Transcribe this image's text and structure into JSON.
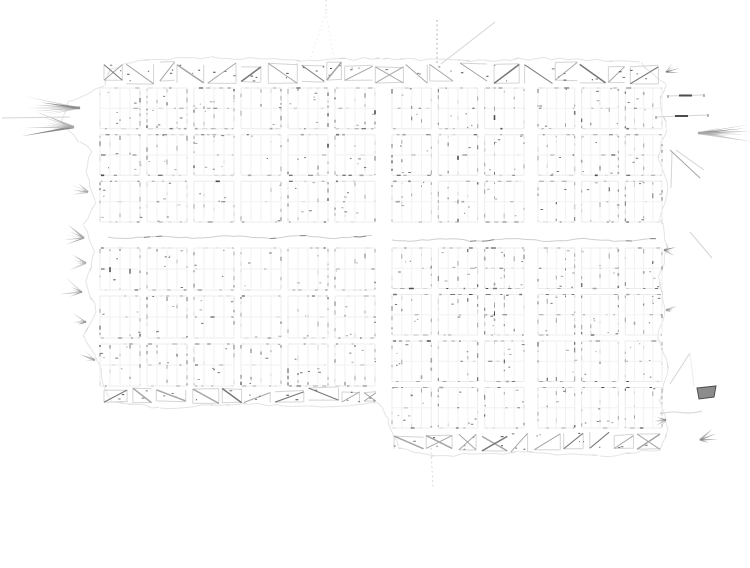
{
  "page": {
    "background": "#ffffff"
  },
  "map": {
    "canvas": {
      "width": 750,
      "height": 568
    },
    "seed": 1337,
    "palette": {
      "paper": "#ffffff",
      "faint": "#ececec",
      "lot": "#f2f2f2",
      "light": "#d4d4d4",
      "mid": "#a6a6a6",
      "dark": "#777777",
      "ink": "#4d4d4d",
      "wave": "#cfcfcf",
      "wave_dark": "#8a8a8a",
      "boundary": "#e4e4e4"
    },
    "street_gap": 7,
    "row_gap": 6,
    "sections": [
      {
        "name": "west",
        "x0": 100,
        "x1": 375,
        "cols": 6
      },
      {
        "name": "central",
        "x0": 392,
        "x1": 524,
        "cols": 3
      },
      {
        "name": "east",
        "x0": 538,
        "x1": 662,
        "cols": 3
      }
    ],
    "halves": [
      {
        "name": "north",
        "y0": 88,
        "y1": 222,
        "rows": 3,
        "sections": [
          0,
          1,
          2
        ]
      },
      {
        "name": "south-west",
        "y0": 248,
        "y1": 386,
        "rows": 3,
        "sections": [
          0
        ]
      },
      {
        "name": "south-east",
        "y0": 248,
        "y1": 428,
        "rows": 4,
        "sections": [
          1,
          2
        ]
      }
    ],
    "lots": {
      "cols": 4,
      "rows": 2
    },
    "hatch_bands": [
      {
        "x0": 104,
        "x1": 660,
        "y0": 62,
        "y1": 84
      },
      {
        "x0": 104,
        "x1": 376,
        "y0": 388,
        "y1": 404
      },
      {
        "x0": 394,
        "x1": 660,
        "y0": 432,
        "y1": 452
      }
    ],
    "waves": [
      {
        "x0": 108,
        "x1": 374,
        "y": 237
      },
      {
        "x0": 392,
        "x1": 658,
        "y": 240
      }
    ],
    "fade_zones": [
      {
        "cx": 250,
        "cy": 155,
        "rx": 16,
        "ry": 68
      },
      {
        "cx": 262,
        "cy": 290,
        "rx": 13,
        "ry": 52
      }
    ],
    "dense_zones": [
      {
        "cx": 500,
        "cy": 300,
        "rx": 16,
        "ry": 85
      },
      {
        "cx": 310,
        "cy": 383,
        "rx": 75,
        "ry": 14
      },
      {
        "cx": 185,
        "cy": 118,
        "rx": 65,
        "ry": 26
      }
    ],
    "boundary": [
      [
        104,
        86
      ],
      [
        88,
        94
      ],
      [
        68,
        102
      ],
      [
        62,
        122
      ],
      [
        80,
        142
      ],
      [
        92,
        152
      ],
      [
        86,
        172
      ],
      [
        96,
        202
      ],
      [
        84,
        226
      ],
      [
        94,
        252
      ],
      [
        86,
        282
      ],
      [
        96,
        312
      ],
      [
        84,
        336
      ],
      [
        98,
        362
      ],
      [
        104,
        386
      ],
      [
        112,
        402
      ],
      [
        160,
        408
      ],
      [
        250,
        404
      ],
      [
        330,
        407
      ],
      [
        378,
        403
      ],
      [
        388,
        420
      ],
      [
        398,
        448
      ],
      [
        430,
        456
      ],
      [
        520,
        452
      ],
      [
        600,
        456
      ],
      [
        660,
        450
      ],
      [
        668,
        430
      ],
      [
        660,
        400
      ],
      [
        668,
        368
      ],
      [
        658,
        338
      ],
      [
        665,
        308
      ],
      [
        658,
        278
      ],
      [
        668,
        248
      ],
      [
        660,
        218
      ],
      [
        668,
        188
      ],
      [
        658,
        158
      ],
      [
        666,
        128
      ],
      [
        660,
        98
      ],
      [
        666,
        84
      ],
      [
        640,
        62
      ],
      [
        560,
        58
      ],
      [
        470,
        61
      ],
      [
        380,
        58
      ],
      [
        300,
        61
      ],
      [
        210,
        57
      ],
      [
        140,
        60
      ],
      [
        110,
        70
      ],
      [
        104,
        86
      ]
    ],
    "features": [
      {
        "type": "rays",
        "x": 80,
        "y": 108,
        "dir": 180,
        "count": 7,
        "len": 58,
        "spread": 24
      },
      {
        "type": "rays",
        "x": 74,
        "y": 127,
        "dir": 186,
        "count": 8,
        "len": 50,
        "spread": 32
      },
      {
        "type": "line",
        "x1": 2,
        "y1": 118,
        "x2": 70,
        "y2": 117,
        "tone": "light"
      },
      {
        "type": "rays",
        "x": 88,
        "y": 192,
        "dir": 196,
        "count": 4,
        "len": 18,
        "spread": 52
      },
      {
        "type": "rays",
        "x": 84,
        "y": 238,
        "dir": 190,
        "count": 5,
        "len": 20,
        "spread": 60
      },
      {
        "type": "rays",
        "x": 86,
        "y": 263,
        "dir": 184,
        "count": 4,
        "len": 16,
        "spread": 55
      },
      {
        "type": "rays",
        "x": 82,
        "y": 292,
        "dir": 190,
        "count": 5,
        "len": 21,
        "spread": 62
      },
      {
        "type": "rays",
        "x": 86,
        "y": 322,
        "dir": 188,
        "count": 4,
        "len": 16,
        "spread": 50
      },
      {
        "type": "rays",
        "x": 95,
        "y": 360,
        "dir": 200,
        "count": 3,
        "len": 14,
        "spread": 42
      },
      {
        "type": "rays",
        "x": 666,
        "y": 72,
        "dir": -25,
        "count": 4,
        "len": 16,
        "spread": 55
      },
      {
        "type": "dashline",
        "x1": 668,
        "y1": 96,
        "x2": 704,
        "y2": 95
      },
      {
        "type": "dashline",
        "x1": 656,
        "y1": 117,
        "x2": 708,
        "y2": 115
      },
      {
        "type": "rays",
        "x": 698,
        "y": 133,
        "dir": -2,
        "count": 7,
        "len": 52,
        "spread": 22
      },
      {
        "type": "line",
        "x1": 670,
        "y1": 150,
        "x2": 700,
        "y2": 178,
        "tone": "mid"
      },
      {
        "type": "line",
        "x1": 676,
        "y1": 150,
        "x2": 704,
        "y2": 170,
        "tone": "light"
      },
      {
        "type": "line",
        "x1": 672,
        "y1": 152,
        "x2": 671,
        "y2": 188,
        "tone": "light"
      },
      {
        "type": "rays",
        "x": 664,
        "y": 250,
        "dir": 8,
        "count": 3,
        "len": 14,
        "spread": 42
      },
      {
        "type": "line",
        "x1": 690,
        "y1": 232,
        "x2": 712,
        "y2": 258,
        "tone": "light"
      },
      {
        "type": "rays",
        "x": 666,
        "y": 310,
        "dir": 0,
        "count": 3,
        "len": 12,
        "spread": 40
      },
      {
        "type": "line",
        "x1": 690,
        "y1": 353,
        "x2": 670,
        "y2": 384,
        "tone": "light"
      },
      {
        "type": "line",
        "x1": 690,
        "y1": 353,
        "x2": 694,
        "y2": 386,
        "tone": "faint"
      },
      {
        "type": "blob",
        "pts": [
          [
            697,
            388
          ],
          [
            716,
            386
          ],
          [
            714,
            397
          ],
          [
            699,
            399
          ]
        ]
      },
      {
        "type": "wavy",
        "x1": 660,
        "y1": 414,
        "x2": 702,
        "y2": 411,
        "amp": 3,
        "tone": "light"
      },
      {
        "type": "rays",
        "x": 666,
        "y": 420,
        "dir": 162,
        "count": 4,
        "len": 14,
        "spread": 70
      },
      {
        "type": "rays",
        "x": 700,
        "y": 440,
        "dir": -12,
        "count": 4,
        "len": 18,
        "spread": 60
      },
      {
        "type": "dotline",
        "x1": 326,
        "y1": 0,
        "x2": 326,
        "y2": 12,
        "tone": "light"
      },
      {
        "type": "dotline",
        "x1": 326,
        "y1": 12,
        "x2": 310,
        "y2": 60,
        "tone": "faint"
      },
      {
        "type": "dotline",
        "x1": 326,
        "y1": 12,
        "x2": 334,
        "y2": 58,
        "tone": "faint"
      },
      {
        "type": "dotline",
        "x1": 437,
        "y1": 20,
        "x2": 437,
        "y2": 64,
        "tone": "mid"
      },
      {
        "type": "line",
        "x1": 495,
        "y1": 22,
        "x2": 441,
        "y2": 64,
        "tone": "light"
      },
      {
        "type": "dotline",
        "x1": 431,
        "y1": 448,
        "x2": 433,
        "y2": 487,
        "tone": "light"
      }
    ]
  }
}
